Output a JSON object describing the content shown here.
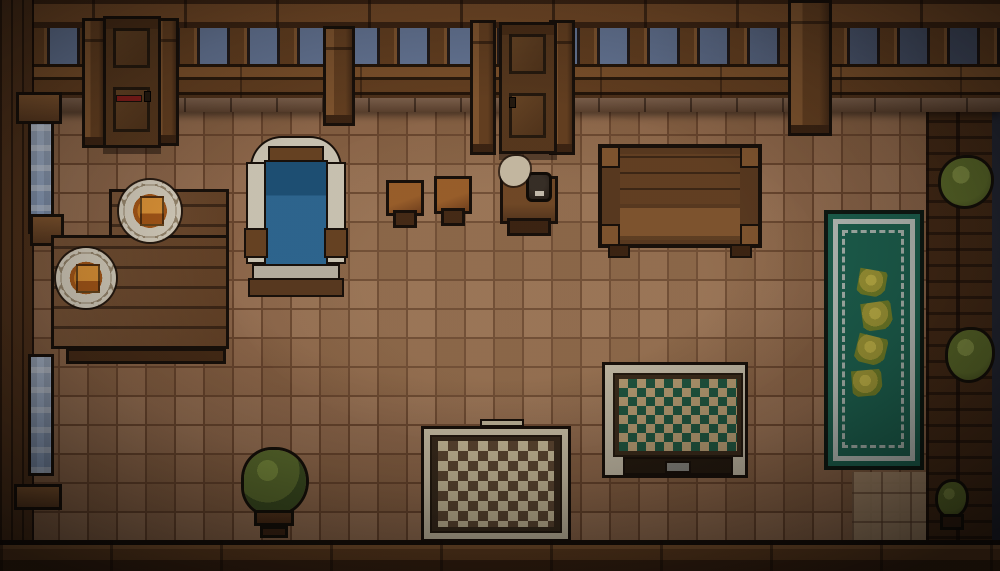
{
  "scene": {
    "title": "pixel-art tavern room interior (top-down)",
    "objects": [
      {
        "id": "wall-top",
        "label": "wooden wall with balustrade and sky openings"
      },
      {
        "id": "door-left",
        "label": "wooden door with red sign"
      },
      {
        "id": "door-center",
        "label": "wooden door"
      },
      {
        "id": "window-left-upper",
        "label": "vertical window"
      },
      {
        "id": "window-left-lower",
        "label": "vertical window"
      },
      {
        "id": "dining-table",
        "label": "plank table with two plates of food"
      },
      {
        "id": "plate-of-food",
        "label": "scalloped plate with orange food"
      },
      {
        "id": "bed",
        "label": "blue bed with white frame"
      },
      {
        "id": "stool",
        "label": "small wooden stool"
      },
      {
        "id": "nightstand",
        "label": "nightstand with dark lamp and cream cloth"
      },
      {
        "id": "big-table",
        "label": "large wooden table"
      },
      {
        "id": "rug-teal-runner",
        "label": "teal runner rug with white border and four flowers"
      },
      {
        "id": "rug-diamond",
        "label": "framed rug with green diamond pattern"
      },
      {
        "id": "rug-checker",
        "label": "checkered cream-brown rug"
      },
      {
        "id": "potted-plant",
        "label": "bush in wooden pot"
      },
      {
        "id": "shelf-bush",
        "label": "green bush on right-wall shelf"
      }
    ]
  },
  "palette": {
    "floor_tile": "#9b6f4e",
    "floor_grout": "#6f4a31",
    "floor_light": "#b99b79",
    "wall_wood": "#6b4423",
    "wall_wood_dark": "#53341c",
    "beam": "#7b4f2a",
    "sky": "#6e82a6",
    "sky_dark": "#4a5670",
    "night_edge": "#262b3a",
    "window_glass": "#8ba3c7",
    "window_glass_light": "#b9c9e0",
    "door_wood": "#5d3c20",
    "door_panel": "#6e4a28",
    "door_red": "#8e1f1c",
    "table_wood": "#7a5130",
    "plate_white": "#e9e2d0",
    "food_orange": "#e08a28",
    "food_orange_dark": "#b35f1a",
    "bed_frame": "#ded8c6",
    "bed_blue": "#2f6f9f",
    "bed_blue_dark": "#1d5781",
    "bed_wood": "#6f4826",
    "rug_teal": "#1d6b58",
    "rug_border_white": "#cdd6d0",
    "rug_flower": "#b0a93c",
    "rug_flower_dark": "#7c8c2c",
    "rug_tan": "#c3a87c",
    "rug_green": "#205c45",
    "rug_cream": "#d8cba6",
    "cloth_cream": "#d9cdb4",
    "plant_green": "#5f7330",
    "plant_green_dark": "#3d5122",
    "plant_green_light": "#7e9440",
    "pot_wood": "#59381f"
  }
}
